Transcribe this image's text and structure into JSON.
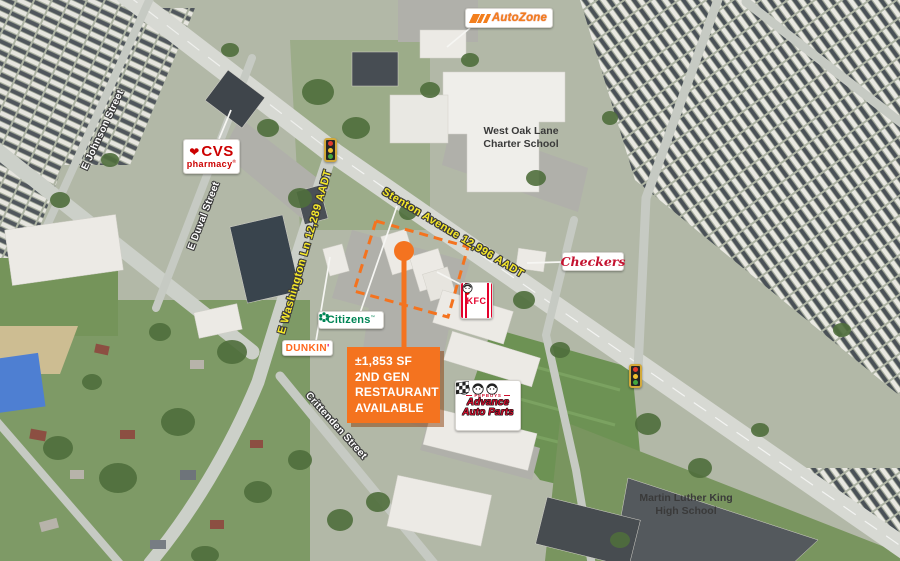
{
  "callout": {
    "lines": [
      "±1,853 SF",
      "2ND GEN",
      "RESTAURANT",
      "AVAILABLE"
    ]
  },
  "streets": {
    "stenton": "Stenton Avenue 12,996 AADT",
    "washington": "E Washington Ln 12,289 AADT",
    "johnson": "E Johnson Street",
    "duval": "E Duval Street",
    "crittenden": "Crittenden Street"
  },
  "places": {
    "charter_school": {
      "line1": "West Oak Lane",
      "line2": "Charter School"
    },
    "mlk_high_school": {
      "line1": "Martin Luther King",
      "line2": "High School"
    }
  },
  "brands": {
    "autozone": {
      "name": "AutoZone"
    },
    "cvs": {
      "name": "CVS",
      "sub": "pharmacy",
      "reg": "®",
      "heart_icon": "❤"
    },
    "checkers": {
      "name": "Checkers"
    },
    "kfc": {
      "name": "KFC"
    },
    "citizens": {
      "name": "Citizens",
      "tm": "™"
    },
    "dunkin": {
      "name": "DUNKIN",
      "apostrophe": "'"
    },
    "advance": {
      "pepboys": "PEPBOYS",
      "line1": "Advance",
      "line2": "Auto Parts"
    }
  },
  "colors": {
    "accent_orange": "#F4731F",
    "aadt_yellow": "#F6E829",
    "street_label_white": "#FFFFFF",
    "school_label_gray": "#3A3A3A",
    "cvs_red": "#CC0000",
    "checkers_red": "#C41230",
    "kfc_red": "#E4002B",
    "citizens_green": "#008555",
    "dunkin_orange": "#FF671F",
    "dunkin_pink": "#DA1884",
    "autozone_orange": "#F37F1D",
    "advance_red": "#CE0E2D"
  }
}
